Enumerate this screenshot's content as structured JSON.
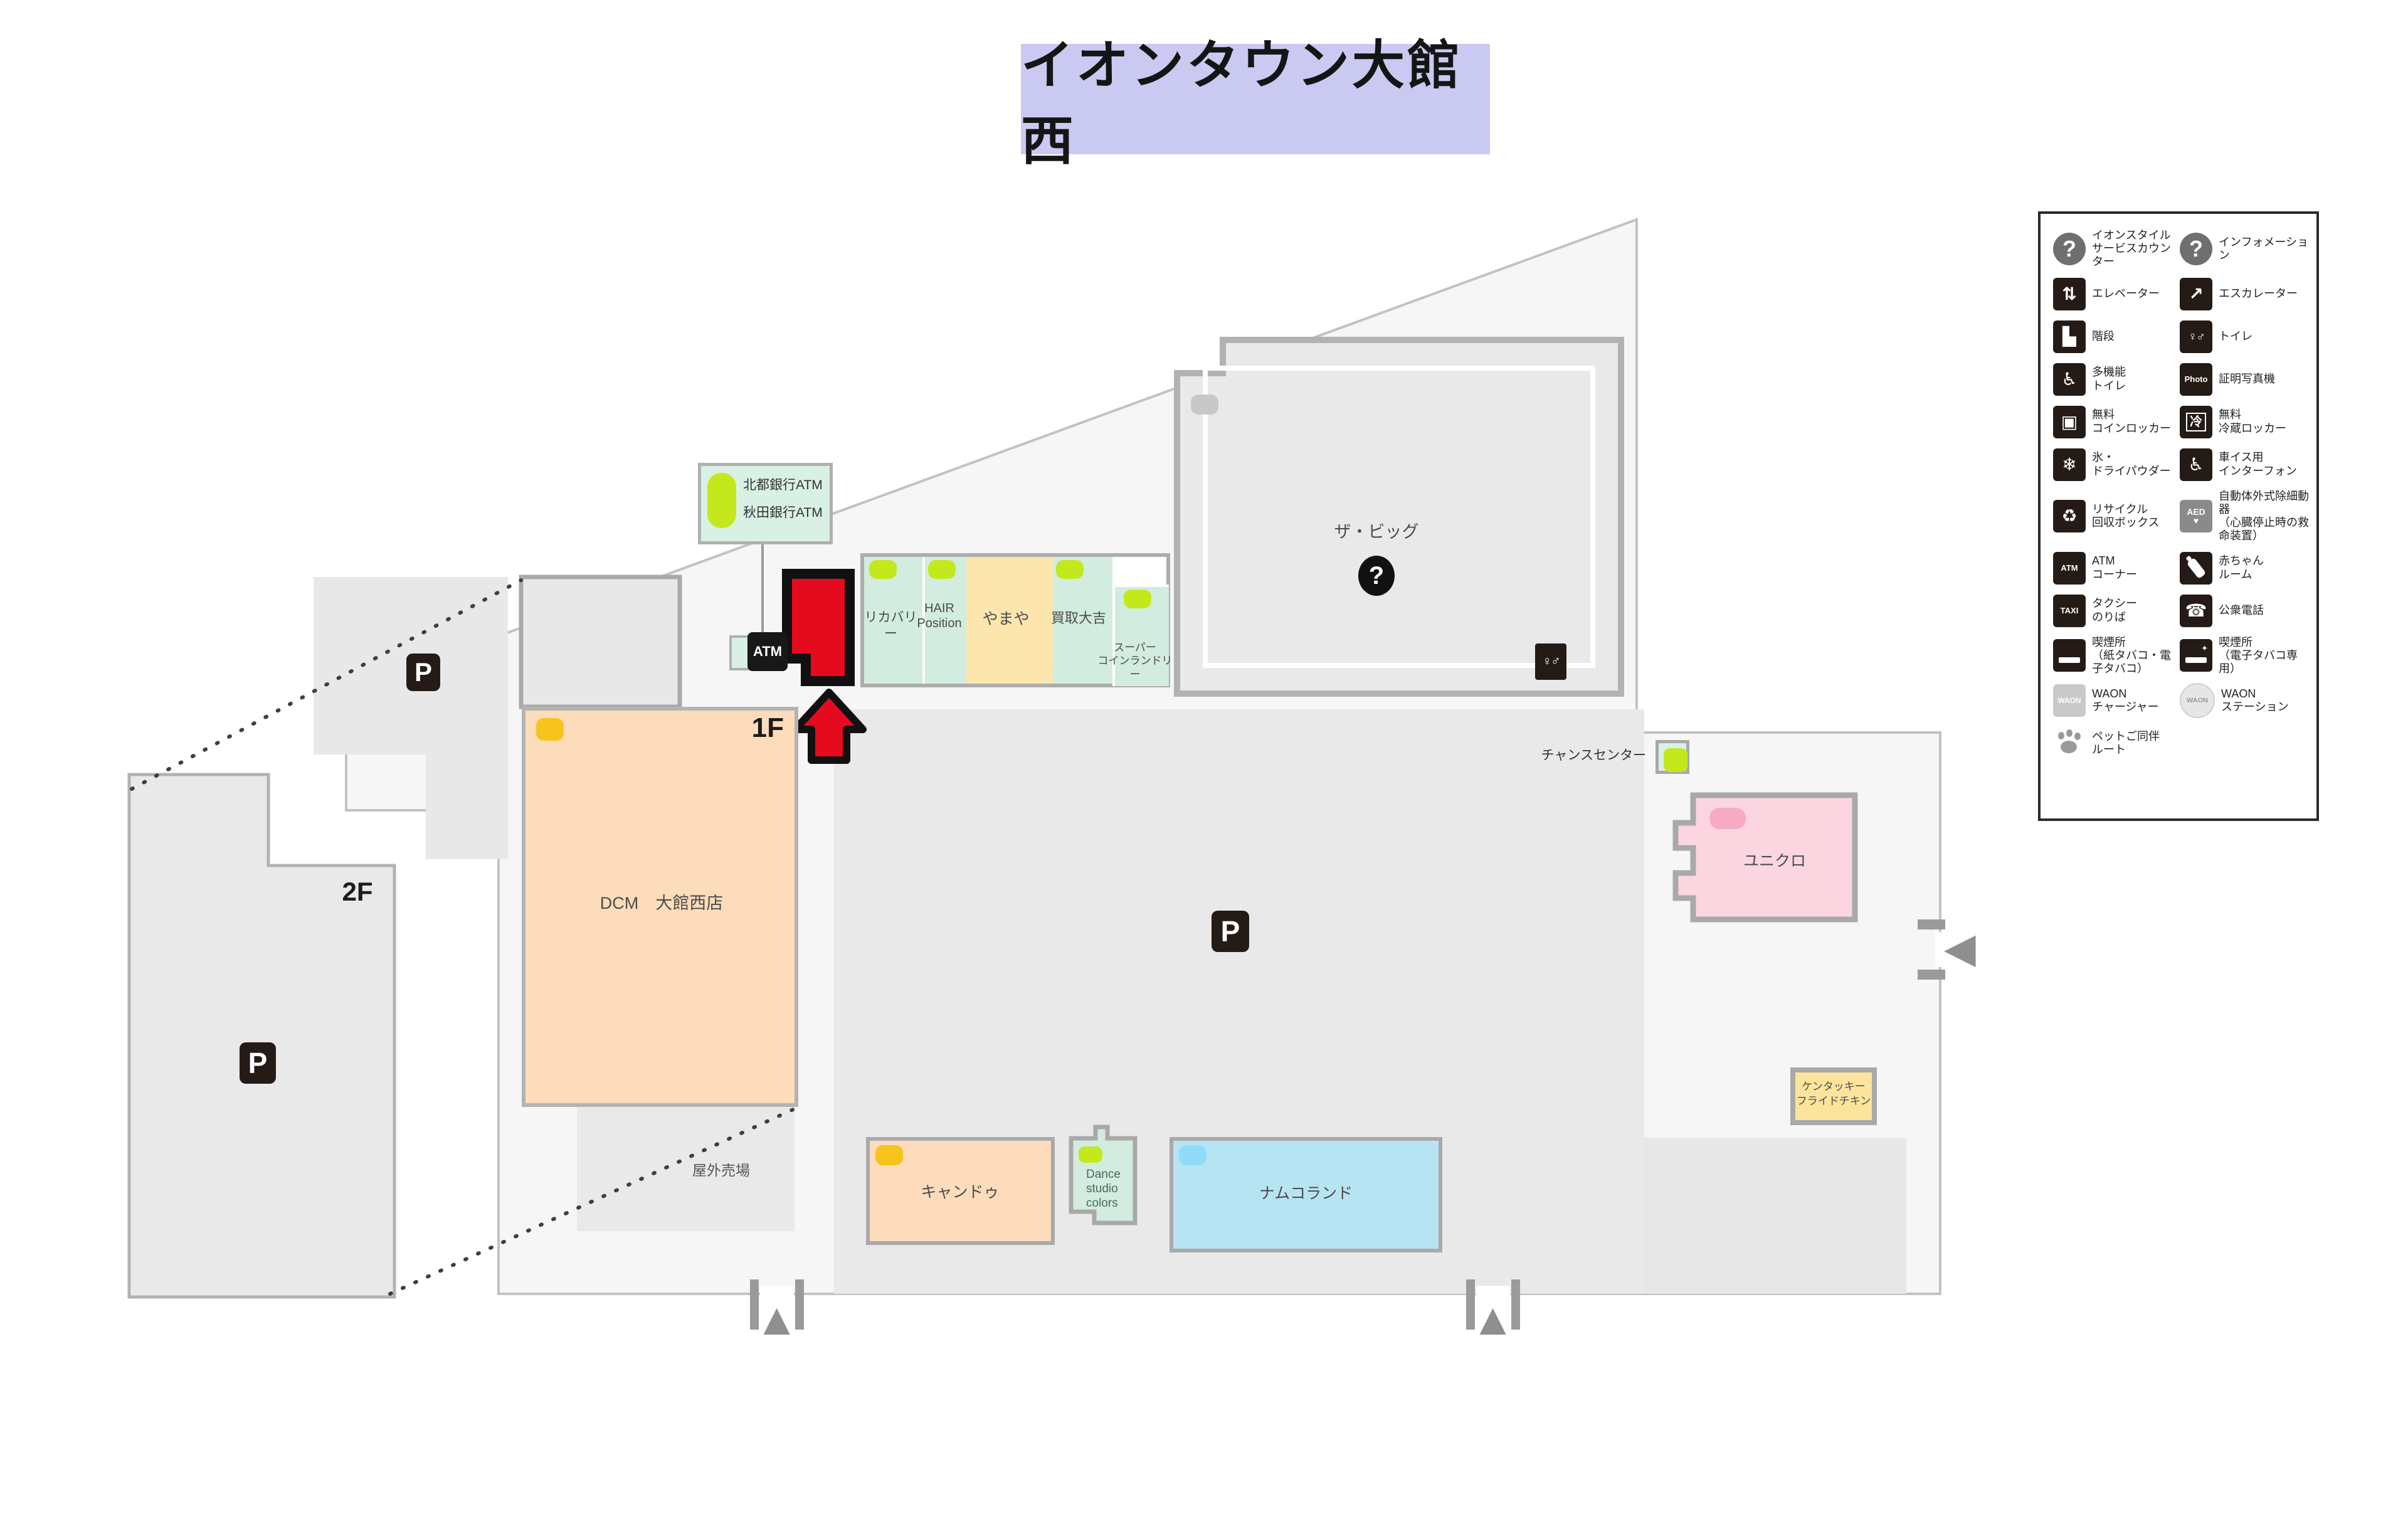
{
  "title": "イオンタウン大館西",
  "map": {
    "labels": {
      "floor_1f": "1F",
      "floor_2f": "2F",
      "outdoor": "屋外売場",
      "chance_center": "チャンスセンター",
      "parking": "P",
      "question": "?",
      "toilet_glyph": "♀♂"
    },
    "atm_callout": {
      "line1": "北都銀行ATM",
      "line2": "秋田銀行ATM",
      "icon": "ATM"
    },
    "stores": {
      "recovery": "リカバリー",
      "hair_l1": "HAIR",
      "hair_l2": "Position",
      "yamaya": "やまや",
      "kaitori": "買取大吉",
      "laundry_l1": "スーパー",
      "laundry_l2": "コインランドリー",
      "the_big": "ザ・ビッグ",
      "dcm": "DCM　大館西店",
      "uniqlo": "ユニクロ",
      "kfc_l1": "ケンタッキー",
      "kfc_l2": "フライドチキン",
      "cando": "キャンドゥ",
      "dance_l1": "Dance",
      "dance_l2": "studio",
      "dance_l3": "colors",
      "namco": "ナムコランド"
    }
  },
  "colors": {
    "highlight_red": "#e60a1e",
    "marker_green": "#c3e91c",
    "marker_yellow": "#f6c41d",
    "marker_pink": "#f8a9c4",
    "marker_blue": "#8edcf8",
    "mint": "#d2ecdf",
    "peach": "#fcdcba",
    "pink": "#fbd6e1",
    "blue": "#b7e4f3",
    "kfc_yellow": "#fce49d",
    "title_bg": "#c9c9f1"
  },
  "legend": {
    "items": [
      {
        "name": "aeon-style-service-counter",
        "style": "circle",
        "glyph": "?",
        "label": "イオンスタイル\nサービスカウンター"
      },
      {
        "name": "information",
        "style": "circle",
        "glyph": "?",
        "label": "インフォメーション"
      },
      {
        "name": "elevator",
        "style": "",
        "glyph": "⇅",
        "label": "エレベーター"
      },
      {
        "name": "escalator",
        "style": "",
        "glyph": "↗",
        "label": "エスカレーター"
      },
      {
        "name": "stairs",
        "style": "",
        "glyph": "▙",
        "label": "階段"
      },
      {
        "name": "toilet",
        "style": "sm",
        "glyph": "♀♂",
        "label": "トイレ"
      },
      {
        "name": "accessible-toilet",
        "style": "",
        "glyph": "♿",
        "label": "多機能\nトイレ"
      },
      {
        "name": "photo-booth",
        "style": "txt",
        "glyph": "Photo",
        "label": "証明写真機"
      },
      {
        "name": "free-coin-locker",
        "style": "",
        "glyph": "▣",
        "label": "無料\nコインロッカー"
      },
      {
        "name": "free-cold-locker",
        "style": "rei",
        "glyph": "冷",
        "label": "無料\n冷蔵ロッカー"
      },
      {
        "name": "ice-dry-powder",
        "style": "",
        "glyph": "❄",
        "label": "氷・\nドライパウダー"
      },
      {
        "name": "wheelchair-interphone",
        "style": "",
        "glyph": "♿",
        "label": "車イス用\nインターフォン"
      },
      {
        "name": "recycle-box",
        "style": "",
        "glyph": "♻",
        "label": "リサイクル\n回収ボックス"
      },
      {
        "name": "aed",
        "style": "aed",
        "glyph": "AED\n♥",
        "label": "自動体外式除細動器\n（心臓停止時の救命装置）"
      },
      {
        "name": "atm-corner",
        "style": "txt",
        "glyph": "ATM",
        "label": "ATM\nコーナー"
      },
      {
        "name": "baby-room",
        "style": "bottle",
        "glyph": "",
        "label": "赤ちゃん\nルーム"
      },
      {
        "name": "taxi-stand",
        "style": "txt",
        "glyph": "TAXI",
        "label": "タクシー\nのりば"
      },
      {
        "name": "public-phone",
        "style": "",
        "glyph": "☎",
        "label": "公衆電話"
      },
      {
        "name": "smoking-area",
        "style": "cig",
        "glyph": "",
        "label": "喫煙所\n（紙タバコ・電子タバコ）"
      },
      {
        "name": "smoking-area-ecig",
        "style": "ecig",
        "glyph": "",
        "label": "喫煙所\n（電子タバコ専用）"
      },
      {
        "name": "waon-charger",
        "style": "waon",
        "glyph": "WAON",
        "label": "WAON\nチャージャー"
      },
      {
        "name": "waon-station",
        "style": "waonst",
        "glyph": "WAON",
        "label": "WAON\nステーション"
      },
      {
        "name": "pet-route",
        "style": "paw",
        "glyph": "",
        "label": "ペットご同伴\nルート"
      }
    ]
  }
}
